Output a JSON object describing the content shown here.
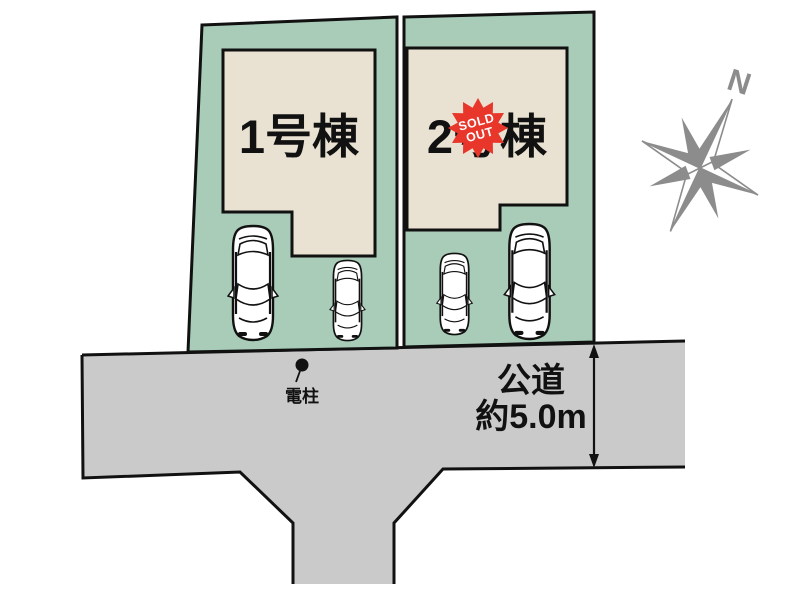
{
  "scene": {
    "plots": [
      {
        "label": "1号棟",
        "sold_out": false
      },
      {
        "label": "2号棟",
        "sold_out": true
      }
    ],
    "sold_badge": {
      "line1": "SOLD",
      "line2": "OUT"
    },
    "road": {
      "name": "公道",
      "width_label": "約5.0m"
    },
    "utility_pole_label": "電柱",
    "compass_north_label": "N",
    "colors": {
      "plot_green": "#a8ccb7",
      "house_beige": "#e9e2d2",
      "road_gray": "#cacaca",
      "badge_red": "#e8362b",
      "compass_gray": "#8c8c8c",
      "line_black": "#111111"
    }
  }
}
